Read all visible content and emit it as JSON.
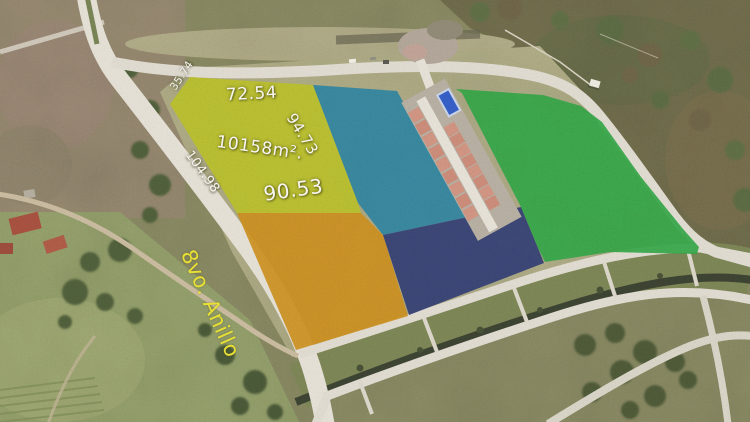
{
  "parcel": {
    "area_label": "10158m².",
    "side_top": "72.54",
    "side_top_left": "35.74",
    "side_right": "94.73",
    "side_left": "104.98",
    "side_bottom": "90.53"
  },
  "street": {
    "name": "8vo. Anillo"
  },
  "colors": {
    "parcel_yellow": "#bcc21f",
    "parcel_teal": "#1f7fa2",
    "parcel_orange": "#cf8e13",
    "parcel_navy": "#283571",
    "parcel_green": "#27a53d",
    "sports_court": "#2b59c9",
    "measurement_text": "#f7f5ef",
    "street_text": "#e9e035"
  }
}
